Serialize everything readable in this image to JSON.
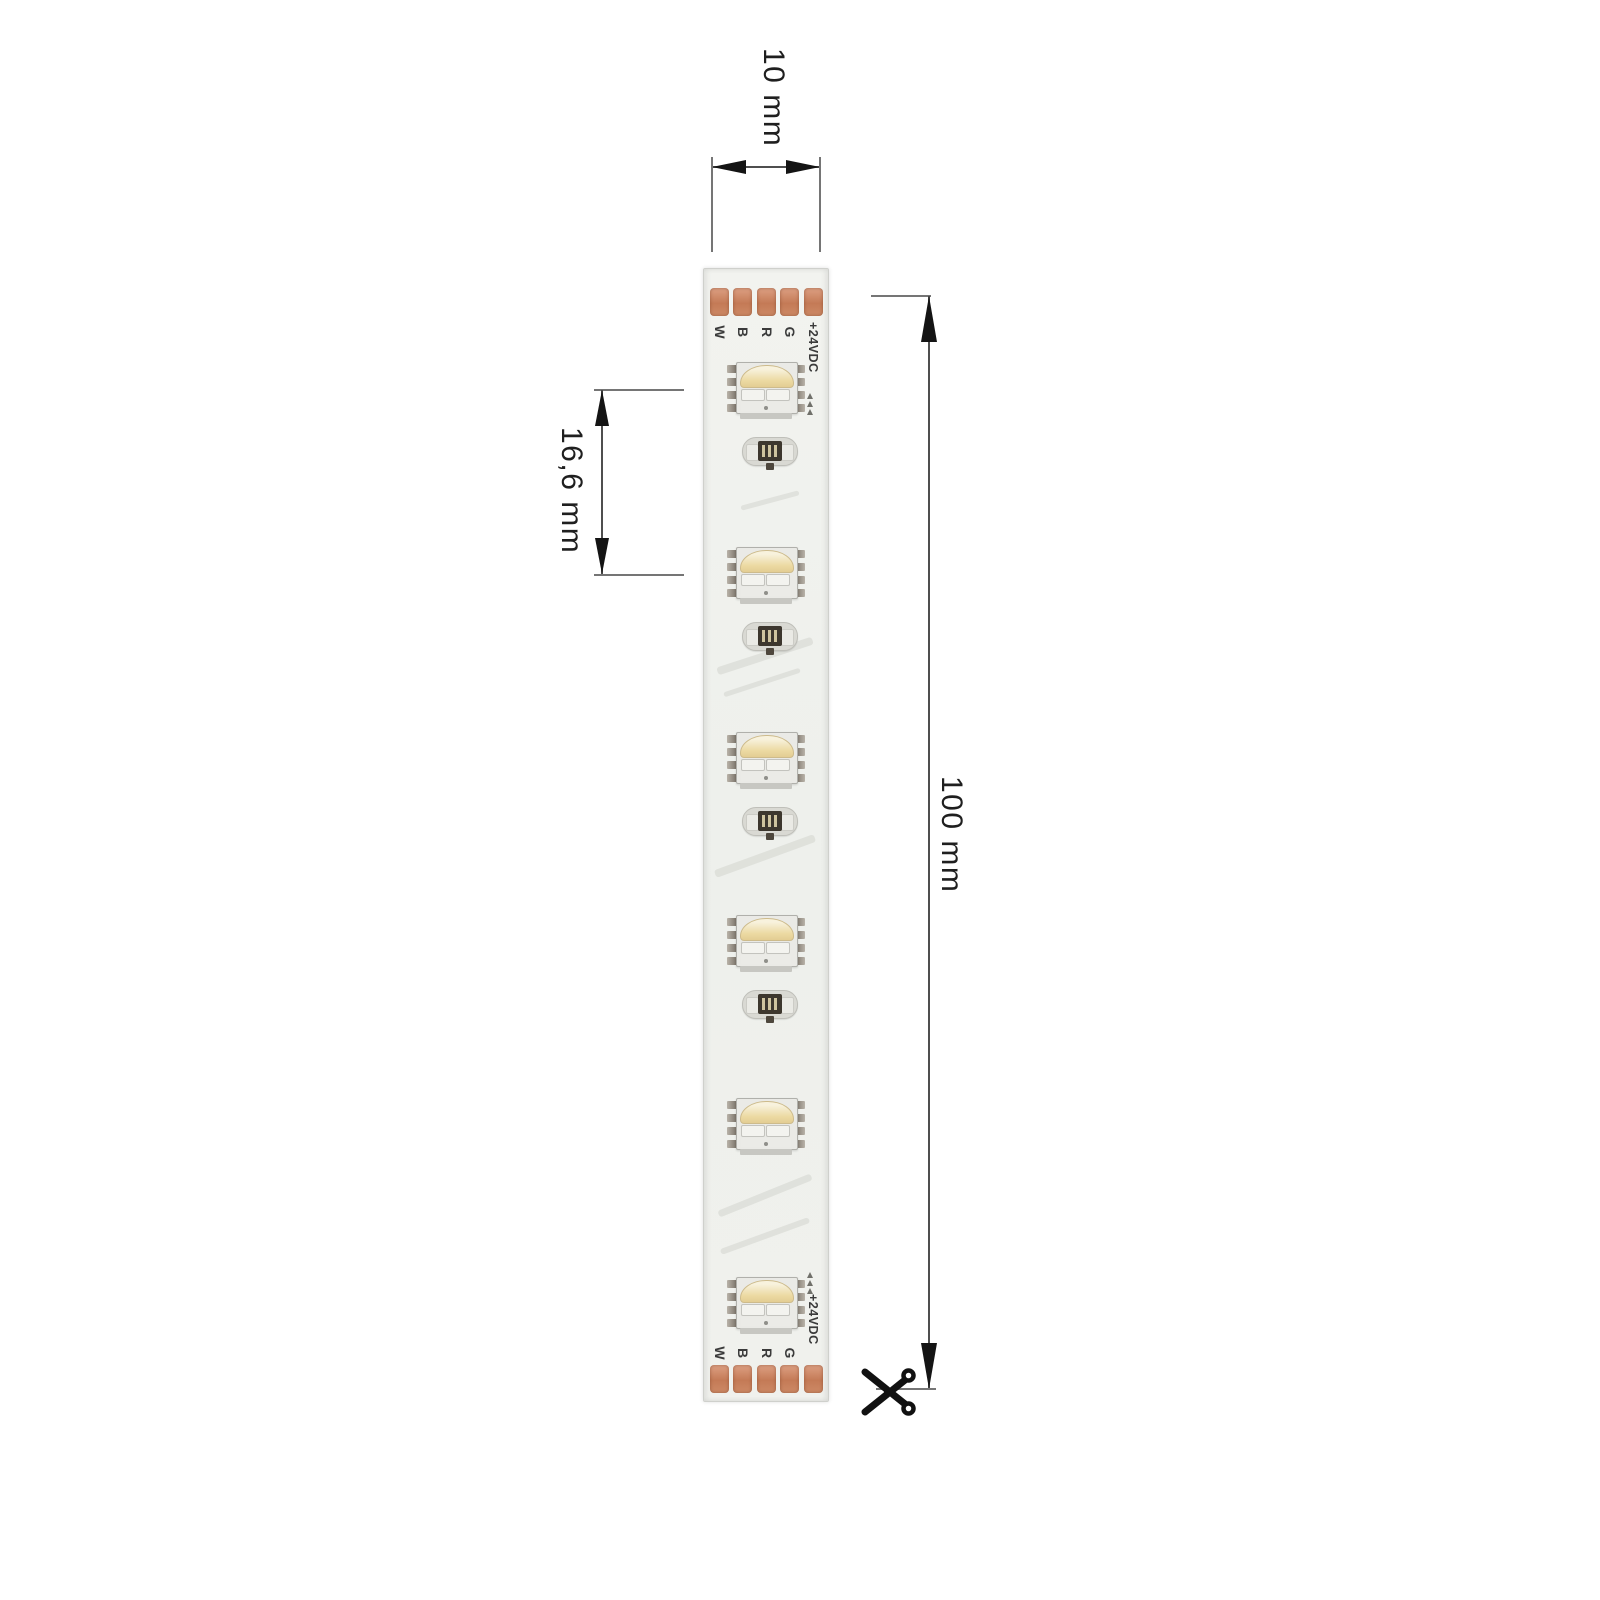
{
  "dimensions": {
    "strip_width": "10 mm",
    "led_pitch": "16,6 mm",
    "cut_length": "100 mm"
  },
  "strip": {
    "pad_labels": [
      "W",
      "B",
      "R",
      "G",
      "+24VDC"
    ],
    "led_count": 6,
    "resistor_count": 4,
    "cut_marker": "scissors"
  },
  "colors": {
    "copper_pad": "#c8805d",
    "led_phosphor": "#ecd9a2",
    "pcb_white": "#f0f1ed",
    "dimension_line": "#4f4f4f",
    "resistor_chip": "#3d372e"
  }
}
